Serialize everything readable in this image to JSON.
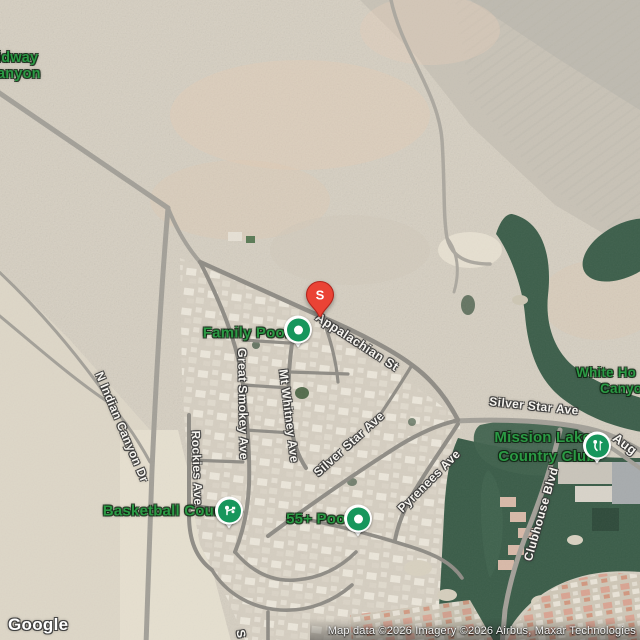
{
  "map": {
    "poi": {
      "midway_canyon": {
        "line1": "idway",
        "line2": "anyon"
      },
      "family_pool": {
        "label": "Family Pool"
      },
      "basketball_court": {
        "label": "Basketball Court"
      },
      "pool_55": {
        "label": "55+ Pool"
      },
      "mission_lakes": {
        "line1": "Mission Lakes",
        "line2": "Country Club"
      },
      "white_canyon": {
        "line1": "White Ho",
        "line2": "Canyo"
      }
    },
    "streets": {
      "appalachian": "Appalachian St",
      "great_smokey": "Great Smokey Ave",
      "mt_whitney": "Mt Whitney Ave",
      "silver_star_inner": "Silver Star Ave",
      "rockies": "Rockies Ave",
      "pyrenees": "Pyrenees Ave",
      "n_indian_canyon": "N Indian Canyon Dr",
      "silver_star_east": "Silver Star Ave",
      "clubhouse": "Clubhouse Blvd",
      "augusta_fragment": "Aug",
      "street_fragment_s": "S"
    },
    "marker": {
      "letter": "S"
    },
    "attribution": {
      "logo": "Google",
      "text": "Map data ©2026 Imagery ©2026 Airbus, Maxar Technologies"
    },
    "colors": {
      "poi_green": "#2b9a44",
      "marker_green": "#17965c",
      "pin_red": "#EA4335",
      "golf_green": "#3c5e4a",
      "road_gray": "#a3a098",
      "desert_tan": "#d6cfc1"
    }
  }
}
